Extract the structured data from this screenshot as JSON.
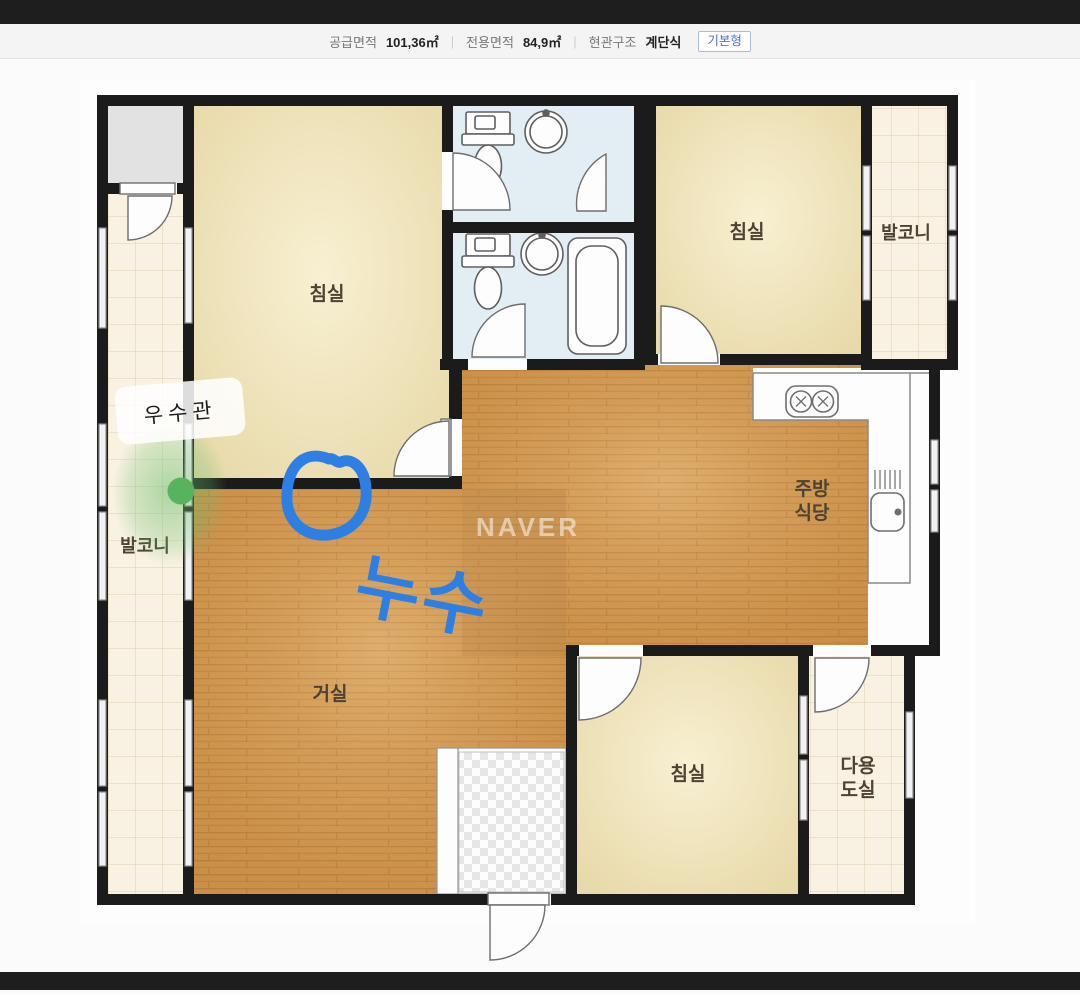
{
  "header": {
    "items": [
      {
        "label": "공급면적",
        "value": "101,36㎡"
      },
      {
        "label": "전용면적",
        "value": "84,9㎡"
      },
      {
        "label": "현관구조",
        "value": "계단식"
      }
    ],
    "separator": "|",
    "badge": "기본형",
    "badge_color": "#4b6fd3"
  },
  "floorplan": {
    "rooms": {
      "bedroom1": "침실",
      "bedroom2": "침실",
      "bedroom3": "침실",
      "balcony_left": "발코니",
      "balcony_right": "발코니",
      "living": "거실",
      "kitchen_line1": "주방",
      "kitchen_line2": "식당",
      "utility_line1": "다용",
      "utility_line2": "도실"
    },
    "watermark": "NAVER",
    "annotations": {
      "leak_label": "누수",
      "pipe_note": "우수관",
      "leak_color": "#2e7fe3",
      "dot_color": "#58b35e"
    }
  }
}
